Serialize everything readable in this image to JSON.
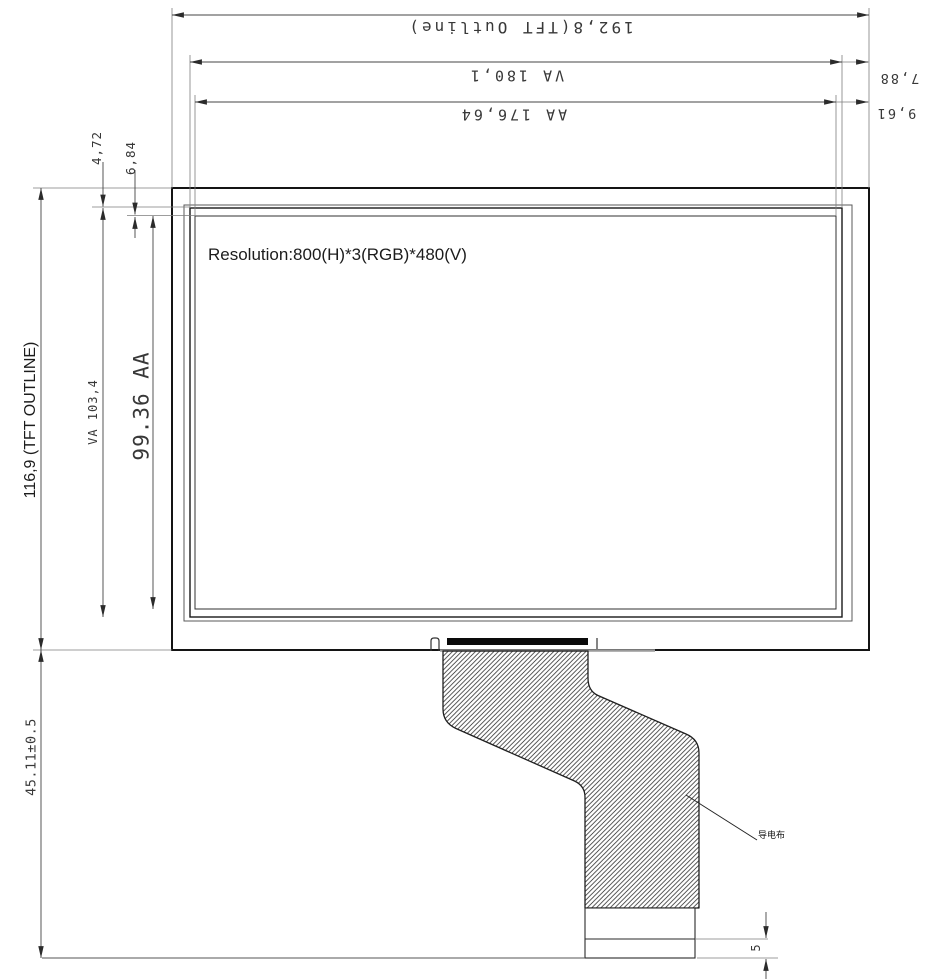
{
  "drawing": {
    "labels": {
      "resolution": "Resolution:800(H)*3(RGB)*480(V)",
      "fpc_leader": "导电布"
    },
    "dimensions": {
      "tft_outline_width": "192,8(TFT Outline)",
      "va_width": "VA 180,1",
      "aa_width": "AA 176,64",
      "va_right_offset": "7,88",
      "aa_right_offset": "9,61",
      "va_top_offset": "4,72",
      "aa_top_offset": "6,84",
      "tft_outline_height": "116,9 (TFT OUTLINE)",
      "va_height": "VA 103,4",
      "aa_height": "99.36 AA",
      "fpc_length": "45.11±0.5",
      "stiffener_height": "5"
    }
  }
}
